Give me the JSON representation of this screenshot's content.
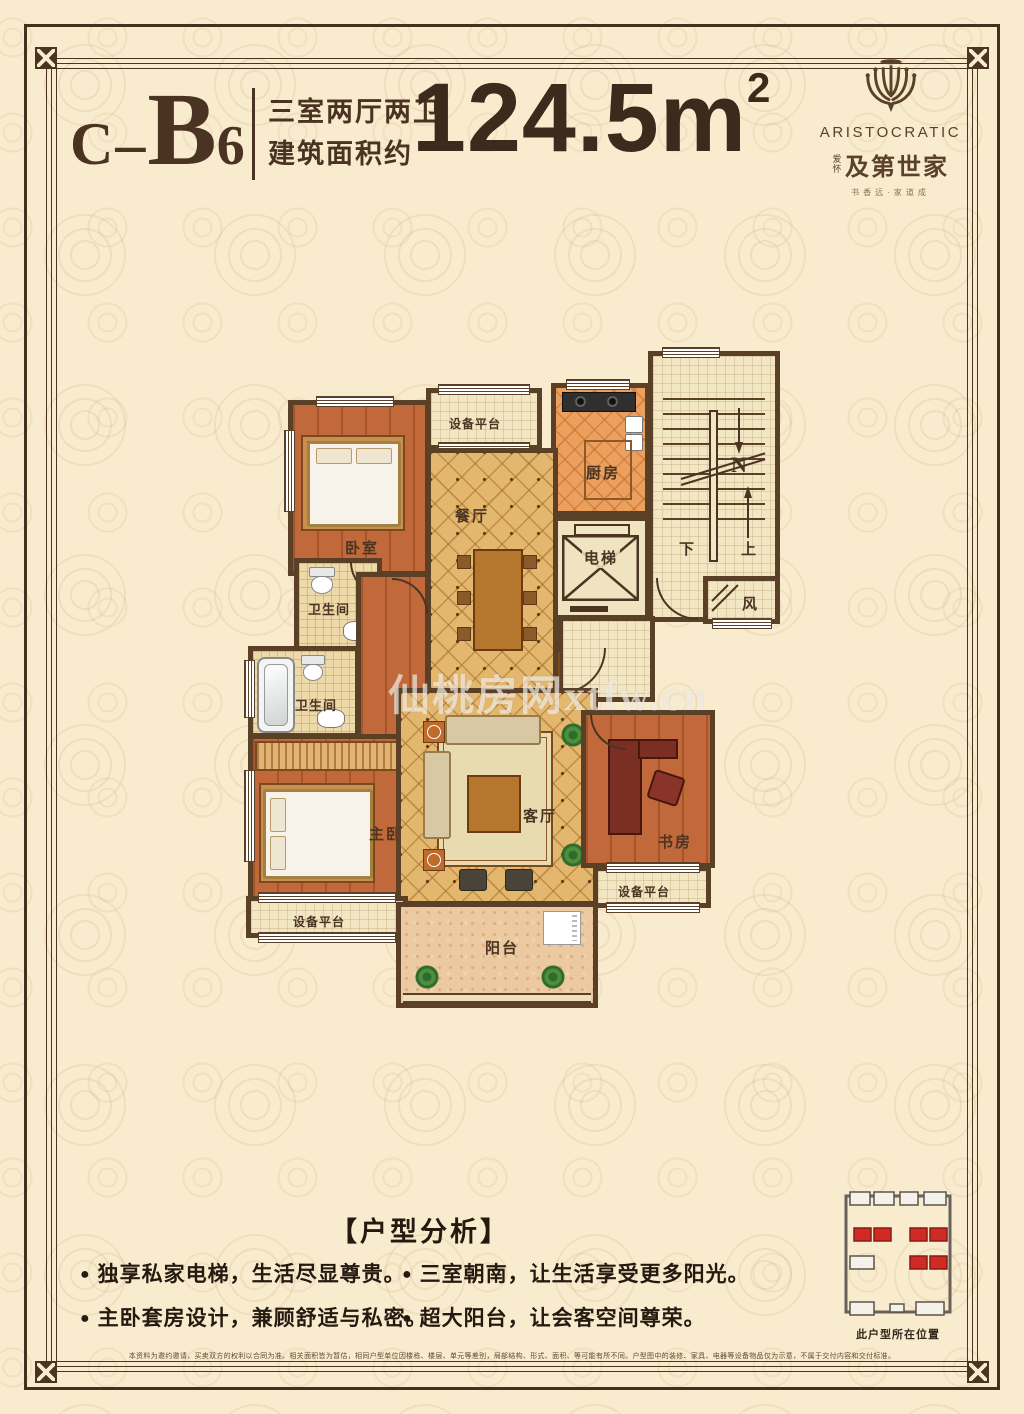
{
  "header": {
    "code": {
      "prefix": "C",
      "dash": "–",
      "letter": "B",
      "digit": "6"
    },
    "type_line1": "三室两厅两卫",
    "type_line2": "建筑面积约",
    "area": {
      "value": "124.5m",
      "sup": "2"
    },
    "logo": {
      "en": "ARISTOCRATIC",
      "prefix_small": "爱怀",
      "cn": "及第世家",
      "tagline": "书香远·家道成"
    }
  },
  "plan": {
    "watermark": "仙桃房网xtfw.cn",
    "labels": {
      "bedroom": "卧室",
      "dining": "餐厅",
      "kitchen": "厨房",
      "elevator": "电梯",
      "equip": "设备平台",
      "bath": "卫生间",
      "master": "主卧",
      "living": "客厅",
      "study": "书房",
      "balcony": "阳台",
      "wind": "风",
      "down": "下",
      "up": "上",
      "north": "N"
    }
  },
  "analysis": {
    "title": "【户型分析】",
    "bullets": [
      "独享私家电梯，生活尽显尊贵。",
      "主卧套房设计，兼顾舒适与私密。",
      "三室朝南，让生活享受更多阳光。",
      "超大阳台，让会客空间尊荣。"
    ]
  },
  "site_map": {
    "caption": "此户型所在位置"
  },
  "disclaimer": "本资料为邀约邀请，买卖双方的权利以合同为准。相关面积皆为暂估，相同户型单位因楼栋、楼层、单元等差别，局部结构、形式、面积、等可能有所不同。户型图中的装修、家具、电器等设备物品仅为示意，不属于交付内容和交付标准。",
  "colors": {
    "wall": "#5a4026",
    "frame": "#4b3522",
    "background": "#f8ebce",
    "accent_red": "#cf2b24",
    "text_dark": "#4a3322"
  }
}
